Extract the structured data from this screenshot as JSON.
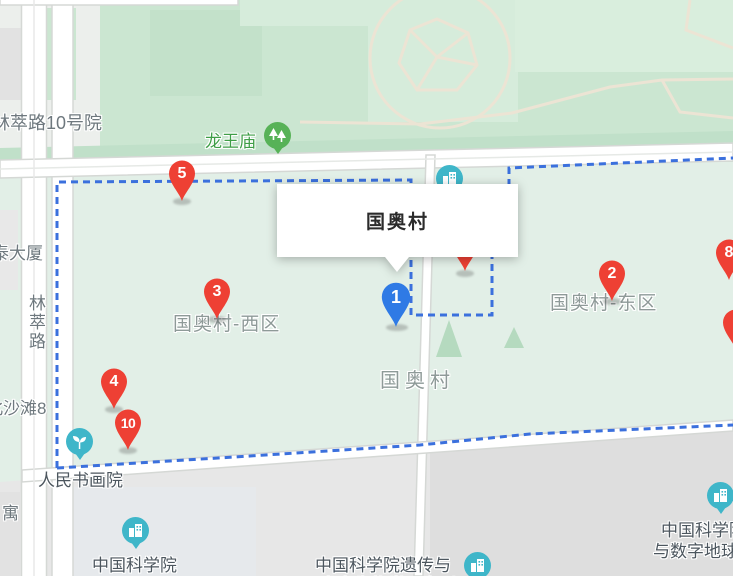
{
  "map": {
    "width": 733,
    "height": 576,
    "infowindow": {
      "title": "国奥村"
    },
    "markers": [
      {
        "label": "1",
        "color": "blue",
        "x": 396,
        "y": 328
      },
      {
        "label": "2",
        "color": "red",
        "x": 612,
        "y": 302
      },
      {
        "label": "3",
        "color": "red",
        "x": 217,
        "y": 320
      },
      {
        "label": "4",
        "color": "red",
        "x": 114,
        "y": 410
      },
      {
        "label": "5",
        "color": "red",
        "x": 182,
        "y": 202
      },
      {
        "label": "8",
        "color": "red",
        "x": 729,
        "y": 281
      },
      {
        "label": "10",
        "color": "red",
        "x": 128,
        "y": 451
      },
      {
        "label": "",
        "color": "red",
        "x": 465,
        "y": 272
      },
      {
        "label": "",
        "color": "red",
        "x": 736,
        "y": 351
      }
    ],
    "area_labels": [
      {
        "text": "国奥村"
      },
      {
        "text": "国奥村-西区"
      },
      {
        "text": "国奥村-东区"
      }
    ],
    "poi_labels": [
      {
        "icon": "trees",
        "text": "龙王庙"
      },
      {
        "icon": "sprout",
        "text": "人民书画院"
      },
      {
        "icon": "building",
        "text": "中国科学院"
      },
      {
        "icon": "building",
        "lines": [
          "中国科学院遗传与",
          "发育生物学研究所"
        ]
      },
      {
        "icon": "building",
        "lines": [
          "中国科学院",
          "与数字地球研"
        ]
      },
      {
        "icon": "building",
        "text": ""
      }
    ],
    "street_labels": [
      {
        "text": "林萃路10号院"
      },
      {
        "text": "泰大厦"
      },
      {
        "text": "林萃路"
      },
      {
        "text": "北沙滩8"
      },
      {
        "text": "寓"
      }
    ],
    "colors": {
      "park_green": "#cbe6d1",
      "park_light": "#d9eedd",
      "village_interior": "#e2efe7",
      "city_gray": "#e7e7e7",
      "road": "#ffffff",
      "boundary_blue": "#3b70dd",
      "marker_red": "#ee4034",
      "marker_blue": "#2f7ae5",
      "poi_teal": "#3fb6c9",
      "poi_green": "#57b257",
      "park_label_green": "#3f9e47",
      "poi_label_gray": "#4c565e",
      "area_label_gray": "#8e9a98"
    }
  }
}
